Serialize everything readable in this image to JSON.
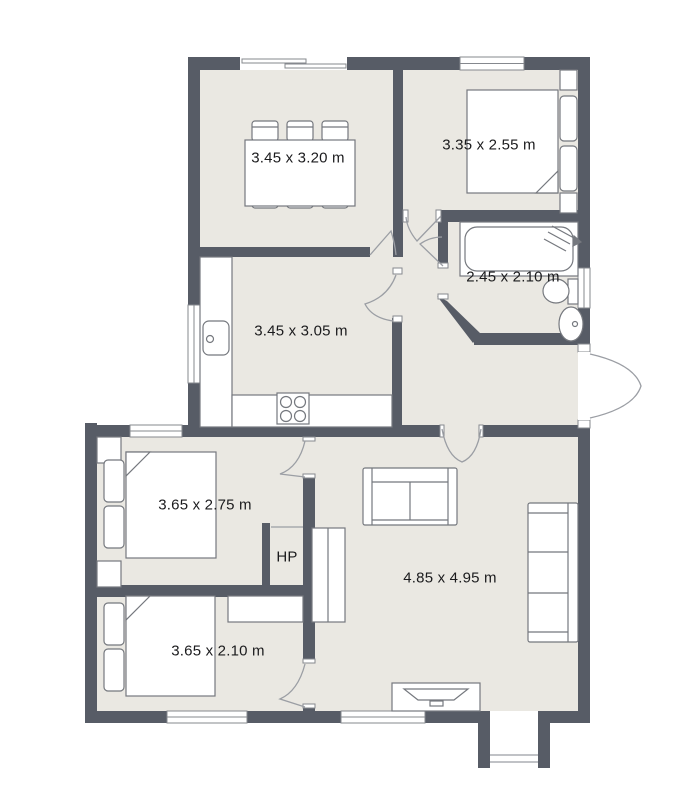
{
  "plan": {
    "rooms": {
      "dining": {
        "label": "3.45 x 3.20 m"
      },
      "bedroom_top": {
        "label": "3.35 x 2.55 m"
      },
      "bathroom": {
        "label": "2.45 x 2.10 m"
      },
      "kitchen": {
        "label": "3.45 x 3.05 m"
      },
      "bedroom_mid": {
        "label": "3.65 x 2.75 m"
      },
      "hot_press": {
        "label": "HP"
      },
      "bedroom_bottom": {
        "label": "3.65 x 2.10 m"
      },
      "living": {
        "label": "4.85 x 4.95 m"
      }
    },
    "colors": {
      "wall": "#575c66",
      "floor": "#eae8e2",
      "furniture_outline": "#75787e",
      "door_arc": "#9b9ea4",
      "window_frame": "#85888e",
      "text": "#1b1b1d",
      "background": "#ffffff"
    }
  }
}
